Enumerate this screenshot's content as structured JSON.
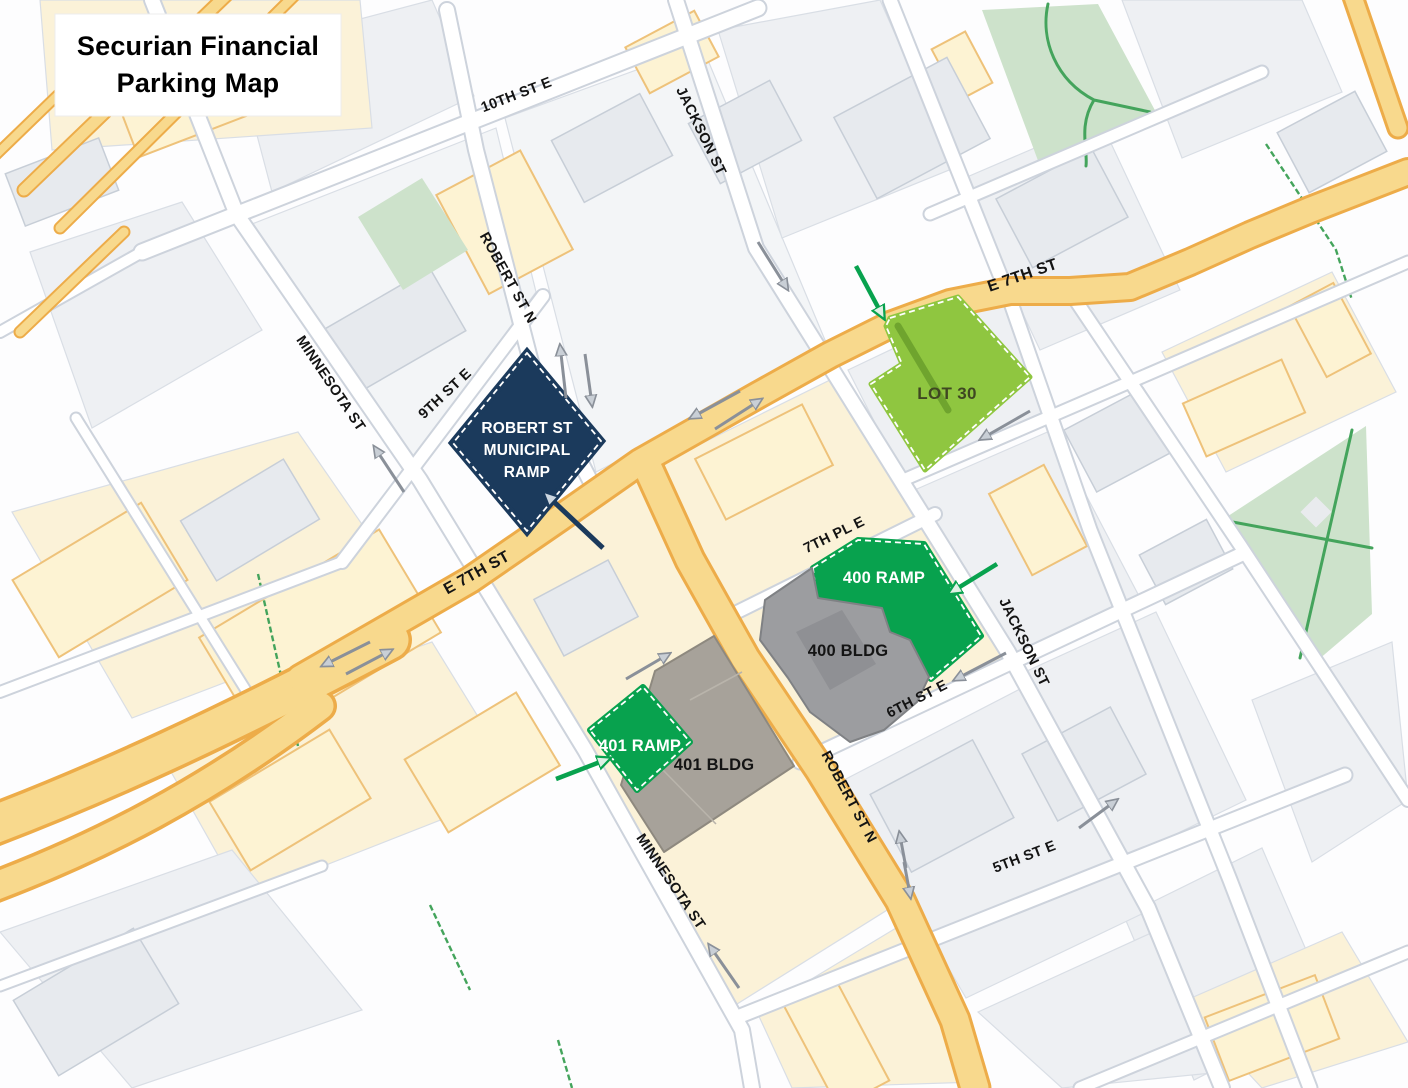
{
  "title": {
    "line1": "Securian Financial",
    "line2": "Parking Map"
  },
  "palette": {
    "block-gray": "#eef0f3",
    "block-gray-light": "#f3f5f7",
    "block-cream": "#fbf2d8",
    "block-stroke": "#d9dee5",
    "bldg-cream": "#fdf3d3",
    "bldg-cream-stroke": "#eec27a",
    "bldg-gray": "#e7eaee",
    "bldg-gray-stroke": "#c7ced7",
    "street-white": "#ffffff",
    "street-casing": "#cdd3dc",
    "road-yellow": "#f8d98d",
    "road-casing": "#edac49",
    "park": "#cde2cb",
    "park-path": "#44a45c",
    "navy": "#1b3a5c",
    "ramp-green": "#08a24e",
    "lot-green": "#8fc640",
    "lot-drive": "#6fa42e",
    "gray-400": "#9c9da0",
    "gray-400-stroke": "#7f8184",
    "taupe-401": "#a7a29a",
    "taupe-401-stroke": "#8e897f",
    "arrow-gray": "#8a9099",
    "arrow-head-light": "#c9cfd6",
    "label": "#141414",
    "lot-label": "#3f4722",
    "title-bg": "#ffffff"
  },
  "streets": {
    "tenth": {
      "label": "10TH ST E"
    },
    "ninth": {
      "label": "9TH ST E"
    },
    "e7Left": {
      "label": "E 7TH ST"
    },
    "e7Right": {
      "label": "E 7TH ST"
    },
    "robertTop": {
      "label": "ROBERT ST N"
    },
    "robertYellow": {
      "label": "ROBERT ST N"
    },
    "minnesotaTop": {
      "label": "MINNESOTA ST"
    },
    "minnesotaBottom": {
      "label": "MINNESOTA ST"
    },
    "jacksonTop": {
      "label": "JACKSON ST"
    },
    "jacksonRight": {
      "label": "JACKSON ST"
    },
    "seventhPl": {
      "label": "7TH PL E"
    },
    "sixth": {
      "label": "6TH ST E"
    },
    "fifth": {
      "label": "5TH ST E"
    }
  },
  "facilities": {
    "municipal": {
      "lines": [
        "ROBERT ST",
        "MUNICIPAL",
        "RAMP"
      ]
    },
    "lot30": {
      "label": "LOT 30"
    },
    "ramp400": {
      "label": "400 RAMP"
    },
    "bldg400": {
      "label": "400 BLDG"
    },
    "ramp401": {
      "label": "401 RAMP"
    },
    "bldg401": {
      "label": "401 BLDG"
    }
  }
}
